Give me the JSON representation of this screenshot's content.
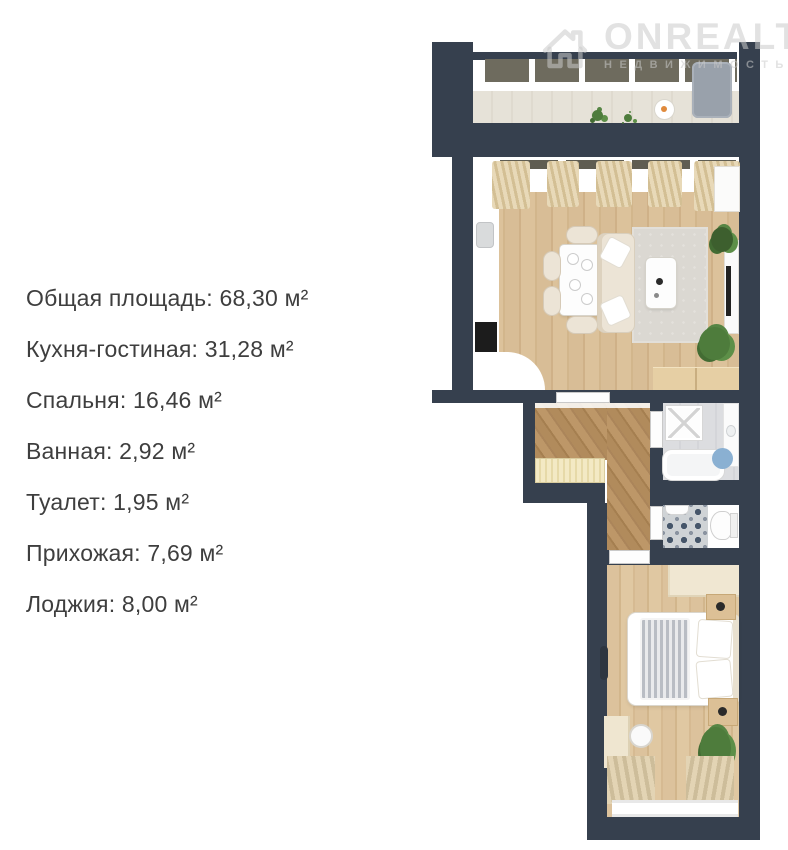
{
  "watermark": {
    "brand": "ONREALT",
    "subtitle": "НЕДВИЖИМОСТЬ"
  },
  "areas": [
    {
      "text": "Общая площадь: 68,30 м²"
    },
    {
      "text": "Кухня-гостиная: 31,28 м²"
    },
    {
      "text": "Спальня: 16,46 м²"
    },
    {
      "text": "Ванная: 2,92 м²"
    },
    {
      "text": "Туалет: 1,95 м²"
    },
    {
      "text": "Прихожая: 7,69 м²"
    },
    {
      "text": "Лоджия: 8,00 м²"
    }
  ],
  "rooms": [
    {
      "name": "Кухня-гостиная",
      "area": "31,28 м²"
    },
    {
      "name": "Спальня",
      "area": "16,46 м²"
    },
    {
      "name": "Ванная",
      "area": "2,92 м²"
    },
    {
      "name": "Туалет",
      "area": "1,95 м²"
    },
    {
      "name": "Прихожая",
      "area": "7,69 м²"
    },
    {
      "name": "Лоджия",
      "area": "8,00 м²"
    }
  ],
  "colors": {
    "bg": "#ffffff",
    "wall": "#36404e",
    "text": "#3e3e3e",
    "wm": "rgba(203,203,203,0.55)",
    "wood-light": "#d5ba92",
    "wood-dark": "#ad8a5e",
    "plant-green": "#4e7c3c",
    "bath-rug-blue": "#8ab0d2",
    "cream": "#ece4d6"
  }
}
